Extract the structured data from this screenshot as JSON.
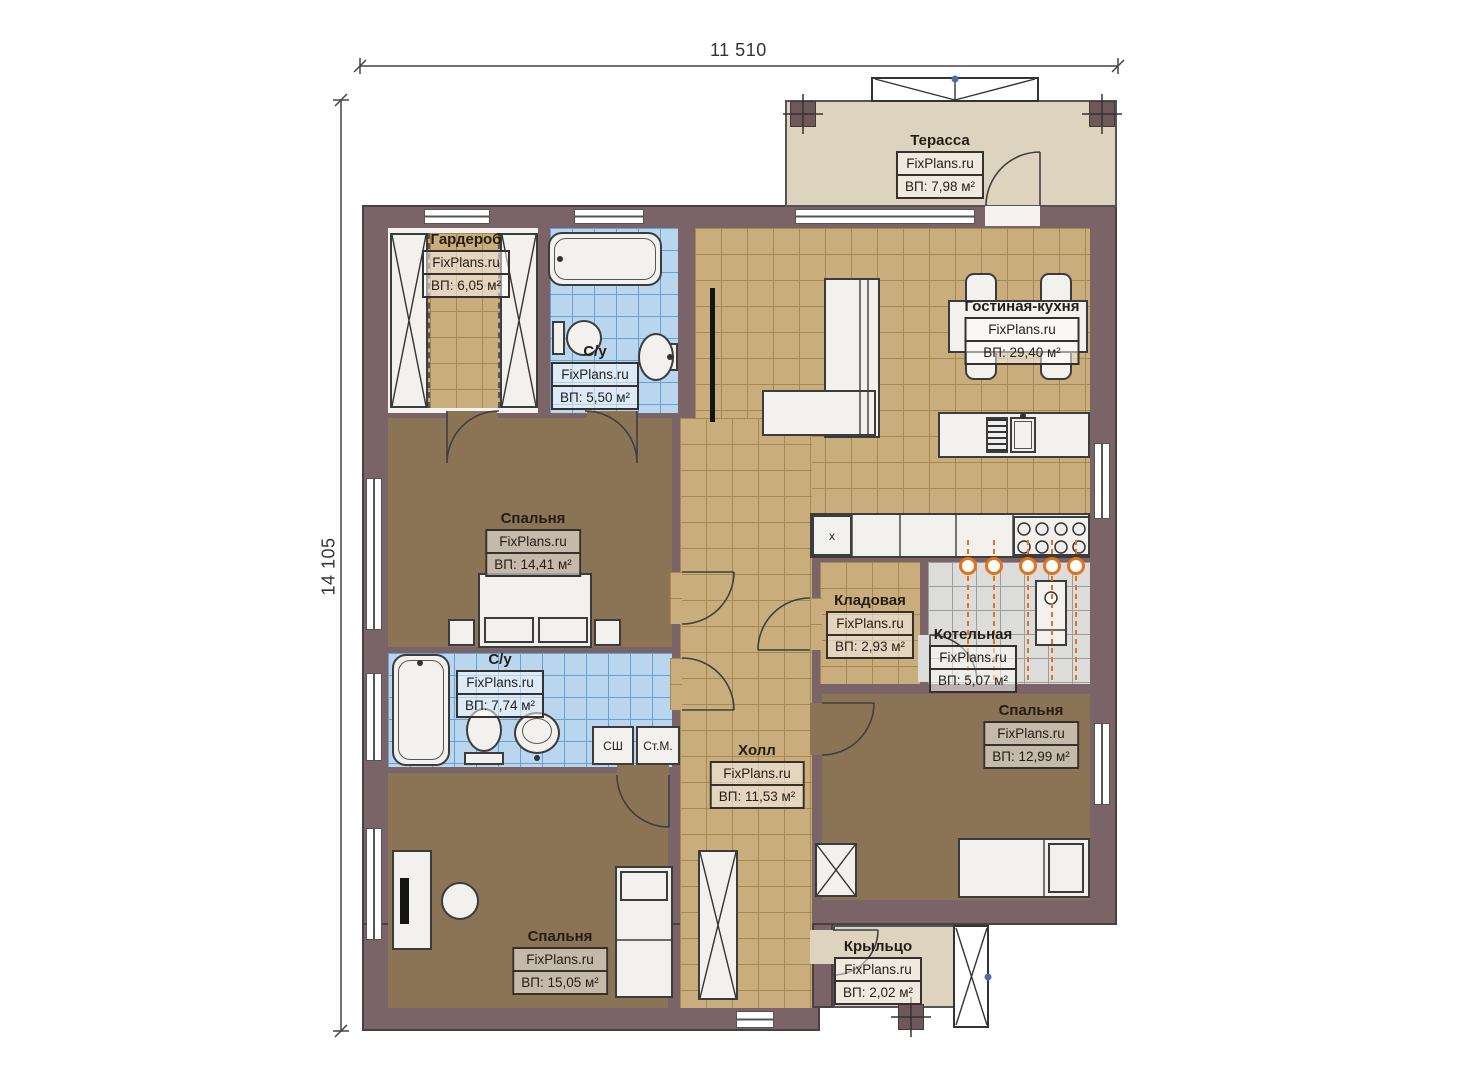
{
  "brand": "FixPlans.ru",
  "dimensions": {
    "width_label": "11 510",
    "height_label": "14 105"
  },
  "rooms": [
    {
      "name": "Терасса",
      "area": "ВП: 7,98 м²"
    },
    {
      "name": "Гардероб",
      "area": "ВП: 6,05 м²"
    },
    {
      "name": "С/у",
      "area": "ВП: 5,50 м²"
    },
    {
      "name": "Гостиная-кухня",
      "area": "ВП: 29,40 м²"
    },
    {
      "name": "Спальня",
      "area": "ВП: 14,41 м²"
    },
    {
      "name": "С/у",
      "area": "ВП: 7,74 м²"
    },
    {
      "name": "Кладовая",
      "area": "ВП: 2,93 м²"
    },
    {
      "name": "Котельная",
      "area": "ВП: 5,07 м²"
    },
    {
      "name": "Холл",
      "area": "ВП: 11,53 м²"
    },
    {
      "name": "Спальня",
      "area": "ВП: 12,99 м²"
    },
    {
      "name": "Спальня",
      "area": "ВП: 15,05 м²"
    },
    {
      "name": "Крыльцо",
      "area": "ВП: 2,02 м²"
    }
  ],
  "appliances": {
    "dryer": "СШ",
    "washer": "Ст.М.",
    "kitchen_unit": "x"
  },
  "colors": {
    "wall": "#7b6467",
    "tile_tan": "#c9ad7c",
    "tile_blue": "#b9d6ee",
    "tile_grey": "#dcdcda",
    "floor_brown": "#8b7355",
    "terrace_beige": "#ded3bf",
    "heating_orange": "#e2731d"
  }
}
